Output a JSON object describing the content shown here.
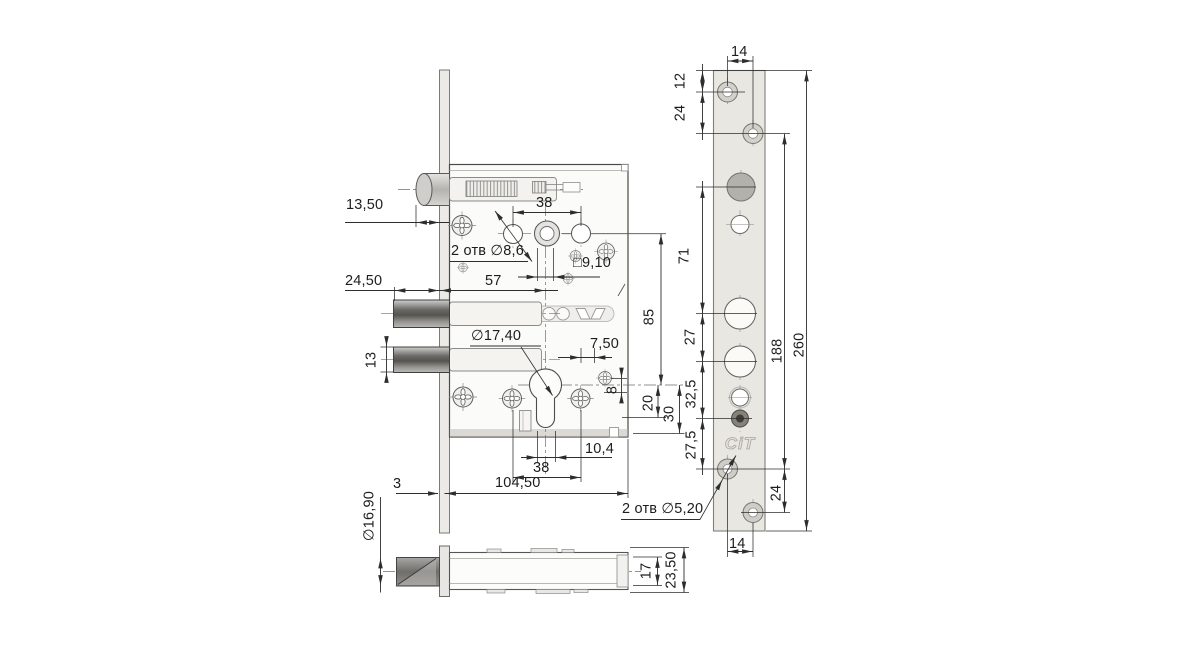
{
  "meta": {
    "logo": "CiT"
  },
  "front_view": {
    "labels": {
      "latch_protrusion": "13,50",
      "top_hole_span": "38",
      "holes_note": "2 отв ∅8,6",
      "spindle_square": "□9,10",
      "bolt_protrusion": "24,50",
      "backset": "57",
      "hub_to_cylinder": "85",
      "cylinder_hole_dia": "∅17,40",
      "hole_offset_7_5": "7,50",
      "bolt_height": "13",
      "offset_8": "8",
      "cyl_to_slot": "20",
      "cyl_to_case_edge": "30",
      "slot_width": "10,4",
      "bottom_hole_span": "38",
      "faceplate_thickness": "3",
      "case_length": "104,50"
    }
  },
  "side_view": {
    "labels": {
      "latch_dia": "∅16,90",
      "body_height": "17",
      "overall_height": "23,50"
    }
  },
  "faceplate_view": {
    "labels": {
      "hole_spacing_top": "14",
      "edge_to_first_hole": "12",
      "first_to_second_hole": "24",
      "span_71": "71",
      "span_27": "27",
      "mount_hole_span": "188",
      "total_length": "260",
      "span_32_5": "32,5",
      "span_27_5": "27,5",
      "bottom_hole_pair": "24",
      "hole_spacing_bottom": "14",
      "holes_note": "2 отв ∅5,20"
    }
  }
}
